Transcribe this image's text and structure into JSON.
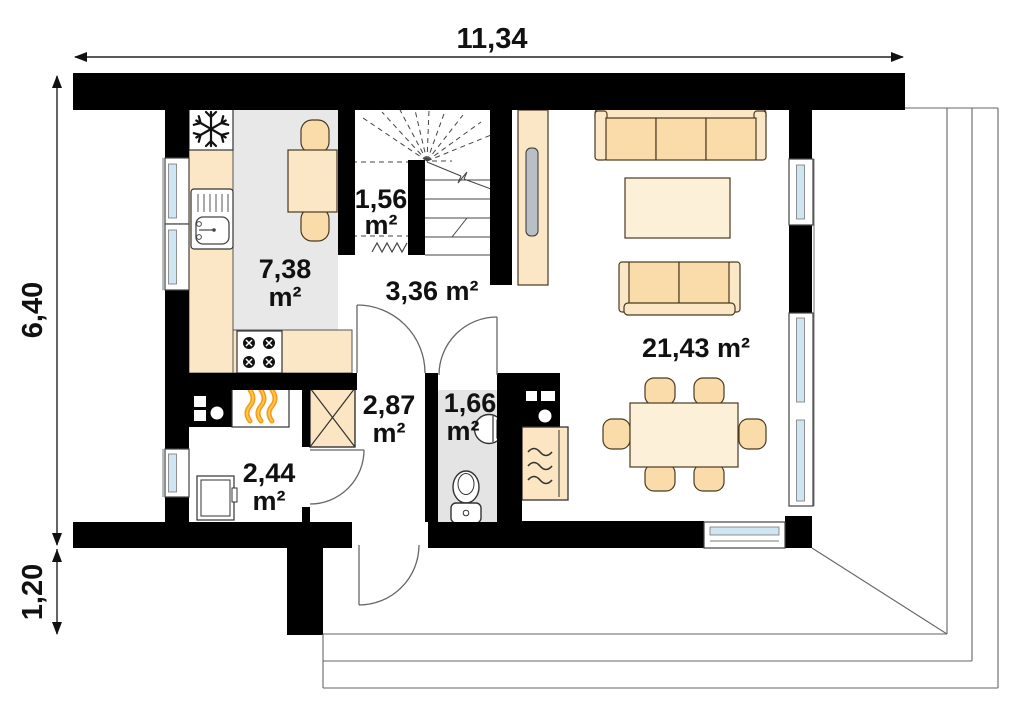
{
  "dimensions": {
    "top_width": "11,34",
    "side_height": "6,40",
    "side_porch_depth": "1,20"
  },
  "rooms": {
    "kitchen": {
      "area": "7,38",
      "unit": "m²"
    },
    "stair_storage": {
      "area": "1,56",
      "unit": "m²"
    },
    "hall": {
      "area_label": "3,36 m²"
    },
    "vestibule": {
      "area": "2,87",
      "unit": "m²"
    },
    "wc": {
      "area": "1,66",
      "unit": "m²"
    },
    "utility": {
      "area": "2,44",
      "unit": "m²"
    },
    "living_room": {
      "area_label": "21,43 m²"
    }
  },
  "colors": {
    "wall": "#000000",
    "kitchen_floor": "#e8e8e8",
    "wc_floor": "#e4e4e4",
    "cabinet_beige": "#fbe7c6",
    "cushion_beige": "#f9dcaa",
    "table_beige": "#fdf0d8",
    "window_glass": "#cfe5f2",
    "flame_orange": "#f59d18",
    "tv_gray": "#b9bfc4"
  }
}
